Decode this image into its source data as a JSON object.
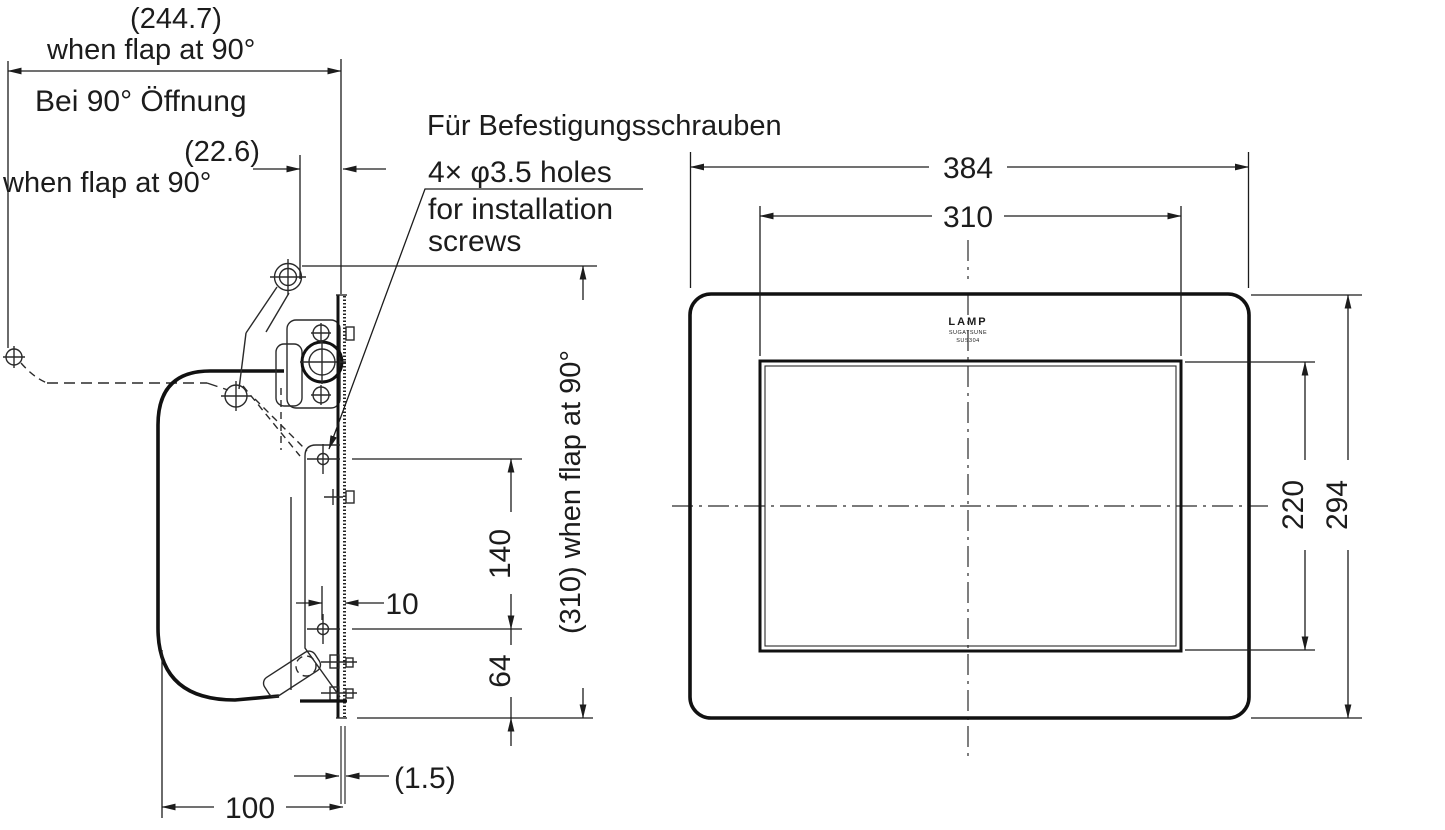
{
  "drawing": {
    "line_color": "#1c1c1c",
    "side_view": {
      "dim_2447": "(244.7)",
      "when_flap_1": "when flap at 90°",
      "bei_90": "Bei 90° Öffnung",
      "dim_226": "(22.6)",
      "when_flap_2": "when flap at 90°",
      "fur_befestigung": "Für Befestigungsschrauben",
      "holes_line1": "4× φ3.5 holes",
      "holes_line2": "for installation",
      "holes_line3": "screws",
      "dim_140": "140",
      "dim_10": "10",
      "dim_64": "64",
      "dim_310_flap": "(310) when flap at 90°",
      "dim_15": "(1.5)",
      "dim_100": "100"
    },
    "front_view": {
      "dim_384": "384",
      "dim_310": "310",
      "dim_220": "220",
      "dim_294": "294",
      "logo_brand": "LAMP",
      "logo_maker": "SUGATSUNE",
      "logo_model": "SUS304"
    }
  }
}
